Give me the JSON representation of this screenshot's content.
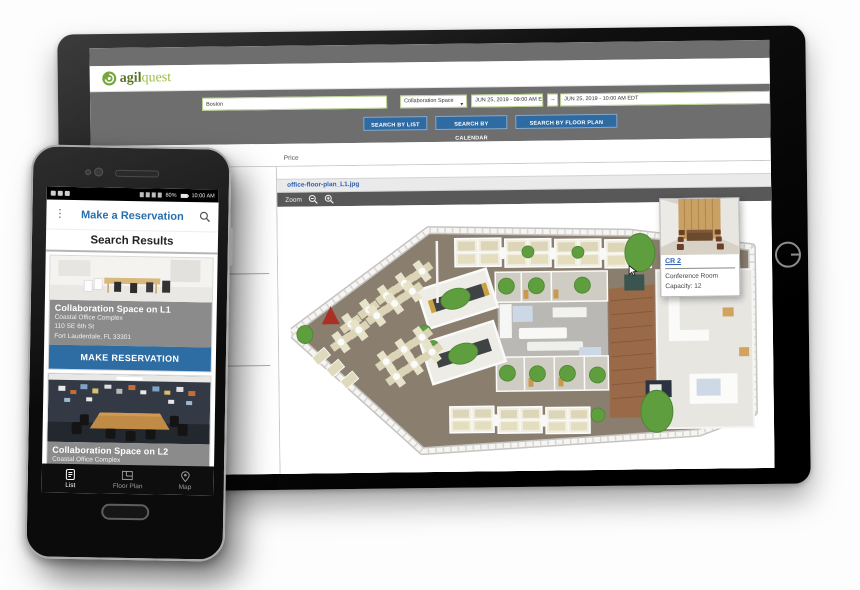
{
  "colors": {
    "brand_green": "#76a63c",
    "accent_blue": "#2f6ba3",
    "marker_green": "#5f9e3e",
    "link_blue": "#2f5fb0",
    "phone_title_blue": "#2a6fad"
  },
  "tablet": {
    "logo": {
      "part_bold": "agil",
      "part_light": "quest"
    },
    "search": {
      "location": "Boston",
      "space_type": "Collaboration Space",
      "start": "JUN 25, 2019 - 09:00 AM EDT",
      "end": "JUN 25, 2019 - 10:00 AM EDT",
      "btn_list": "SEARCH BY LIST",
      "btn_calendar": "SEARCH BY CALENDAR",
      "btn_floorplan": "SEARCH BY FLOOR PLAN"
    },
    "tabs": {
      "price": "Price"
    },
    "floorplan": {
      "file_tab": "office-floor-plan_L1.jpg",
      "zoom_label": "Zoom",
      "popup": {
        "room": "CR 2",
        "type": "Conference Room",
        "capacity": "Capacity: 12"
      }
    }
  },
  "phone": {
    "status": {
      "battery": "80%",
      "time": "10:00 AM"
    },
    "title": "Make a Reservation",
    "results_title": "Search Results",
    "cards": [
      {
        "title": "Collaboration Space on L1",
        "complex": "Coastal Office Complex",
        "street": "110 SE 6th St",
        "city": "Fort Lauderdale, FL 33301",
        "button": "MAKE RESERVATION"
      },
      {
        "title": "Collaboration Space on L2",
        "complex": "Coastal Office Complex"
      }
    ],
    "nav": {
      "list": "List",
      "floor_plan": "Floor Plan",
      "map": "Map"
    }
  }
}
